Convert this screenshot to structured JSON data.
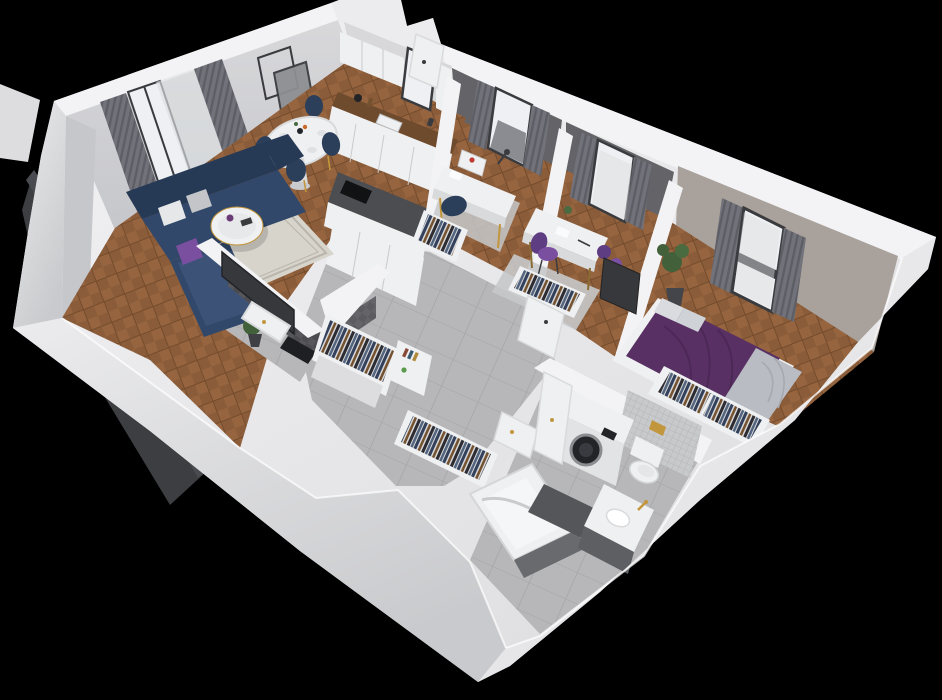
{
  "scene": {
    "title": "3D isometric cutaway rendering of an apartment floor plan on a black background",
    "style": "dollhouse top-down oblique view, white cut walls",
    "background": "#000000"
  },
  "colors": {
    "bg": "#000000",
    "wall-top": "#f3f3f5",
    "wall-light": "#ececee",
    "wall-mid": "#dddde0",
    "wall-shade": "#c9cacd",
    "face-light": "#d8d8db",
    "face-west": "#c6c7cb",
    "office-wall": "#646468",
    "bedroom-wall": "#a9a19b",
    "wood-light": "#96653f",
    "wood-mid": "#8a5c39",
    "wood-dark": "#744c2d",
    "counter-wood": "#6f4b2e",
    "tile-light": "#b7b7b9",
    "tile-grout": "#a4a4a7",
    "tile-dark-wall": "#4b4b50",
    "tile-dark-wall2": "#56565b",
    "mosaic": "#c7c9cb",
    "mosaic-grout": "#b0b2b5",
    "sofa-dark": "#273a55",
    "sofa-mid": "#32486a",
    "sofa-light": "#3c5377",
    "navy-chair": "#2b3e5a",
    "purple": "#7b4fa0",
    "purple-deep": "#5e3d82",
    "bed-purple": "#583063",
    "bed-fold": "#4a2754",
    "blanket-gray": "#b9bcc2",
    "pillow-light": "#d9dbde",
    "white-furn": "#eff0f1",
    "white-furn-shade": "#d9dadc",
    "dark-panel": "#37383c",
    "appliance-dark": "#232428",
    "gold": "#c2963c",
    "plant-green": "#42603a",
    "plant-green-2": "#4a6b40",
    "rug-light": "#d7d4cc",
    "rug-border": "#b9b5ad",
    "rug-gray": "#c7c8ca",
    "curtain": "#72737a",
    "curtain-dark": "#5e5f66",
    "sheer": "#dcdee0",
    "glass": "#eef0f3",
    "frame-dark": "#3a3b3f",
    "mat-dark": "#54565a",
    "mat-black": "#1e1f22",
    "tub-panel": "#686a6e",
    "cabinet-under": "#5d5f63",
    "clothes-bg": "#d8d9db",
    "clothes-navy": "#33415c",
    "clothes-brown": "#74522f",
    "clothes-dark": "#2c2c32",
    "clothes-denim": "#53657e",
    "balcony-dark": "#3d3e42",
    "red-accent": "#c03a34"
  },
  "rooms": [
    {
      "name": "living-room",
      "floor": "herringbone-wood",
      "items": [
        "navy-corner-sofa",
        "white-round-coffee-table",
        "patterned-rug",
        "round-dining-table",
        "4-navy-dining-chairs",
        "gray-curtains",
        "balcony-door",
        "two-wall-frames",
        "potted-plant"
      ]
    },
    {
      "name": "kitchen",
      "floor": "herringbone-wood",
      "items": [
        "white-upper-cabinets",
        "window",
        "wood-countertop",
        "sink",
        "white-lower-cabinets",
        "peninsula-with-black-hob"
      ]
    },
    {
      "name": "office-1",
      "floor": "wood-with-gray-rug",
      "items": [
        "white-desk",
        "printer-with-red-part",
        "desk-lamp",
        "navy-bean-bag",
        "open-wardrobe",
        "window-with-gray-curtains"
      ]
    },
    {
      "name": "office-2",
      "floor": "wood-with-gray-rug",
      "items": [
        "white-desk",
        "purple-chair",
        "purple-floor-cushions",
        "open-wardrobe",
        "window-with-gray-curtains"
      ]
    },
    {
      "name": "bedroom",
      "floor": "herringbone-wood",
      "items": [
        "purple-double-bed",
        "gray-throw-blanket",
        "light-pillows",
        "open-wardrobe-with-clothes",
        "wall-tv",
        "potted-plant",
        "window-with-gray-curtains"
      ]
    },
    {
      "name": "shower-room",
      "floor": "gray-tile",
      "items": [
        "dark-herringbone-tile-walls",
        "white-shower-tray",
        "black-mat",
        "tv-on-outer-wall"
      ]
    },
    {
      "name": "hallway",
      "floor": "large-gray-tiles",
      "items": [
        "open-wardrobe-north",
        "open-wardrobe-south",
        "white-shelf-with-books",
        "white-doors"
      ]
    },
    {
      "name": "bathroom",
      "floor": "gray-tile",
      "items": [
        "washing-machine",
        "wall-hung-toilet",
        "gold-flush-plate",
        "mosaic-half-wall",
        "bathtub-dark-panel",
        "vanity-sink-gold-faucet",
        "dark-bath-mat",
        "open-door"
      ]
    },
    {
      "name": "balcony",
      "floor": "none-visible",
      "items": [
        "dark-railing-panel"
      ]
    }
  ]
}
